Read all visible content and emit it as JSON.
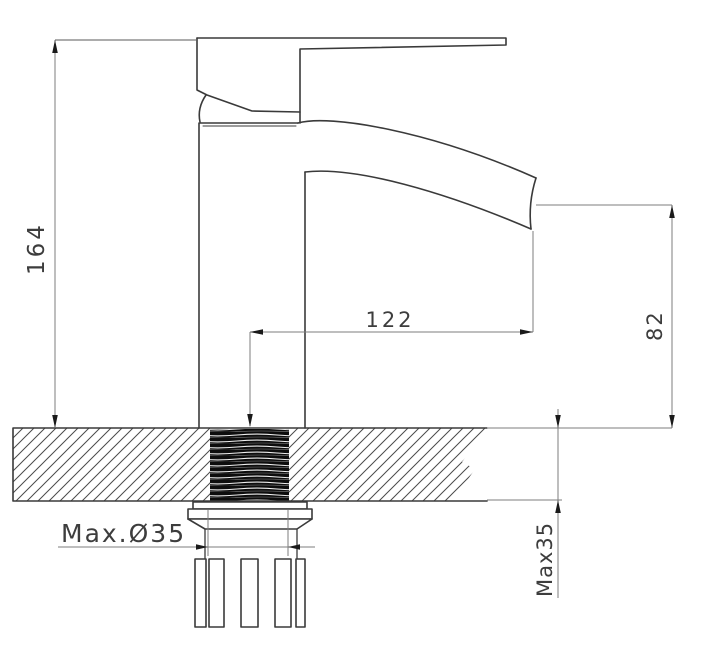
{
  "labels": {
    "total_height": "164",
    "spout_reach": "122",
    "spout_height": "82",
    "max_hole_diameter": "Max.Ø35",
    "max_deck_thickness": "Max35"
  },
  "colors": {
    "object_line": "#3a3a3a",
    "dimension_line": "#7d7d7d",
    "arrow": "#1a1a1a",
    "text": "#3d3d3d",
    "thread_fill": "#0d0d0d",
    "background": "#ffffff"
  }
}
